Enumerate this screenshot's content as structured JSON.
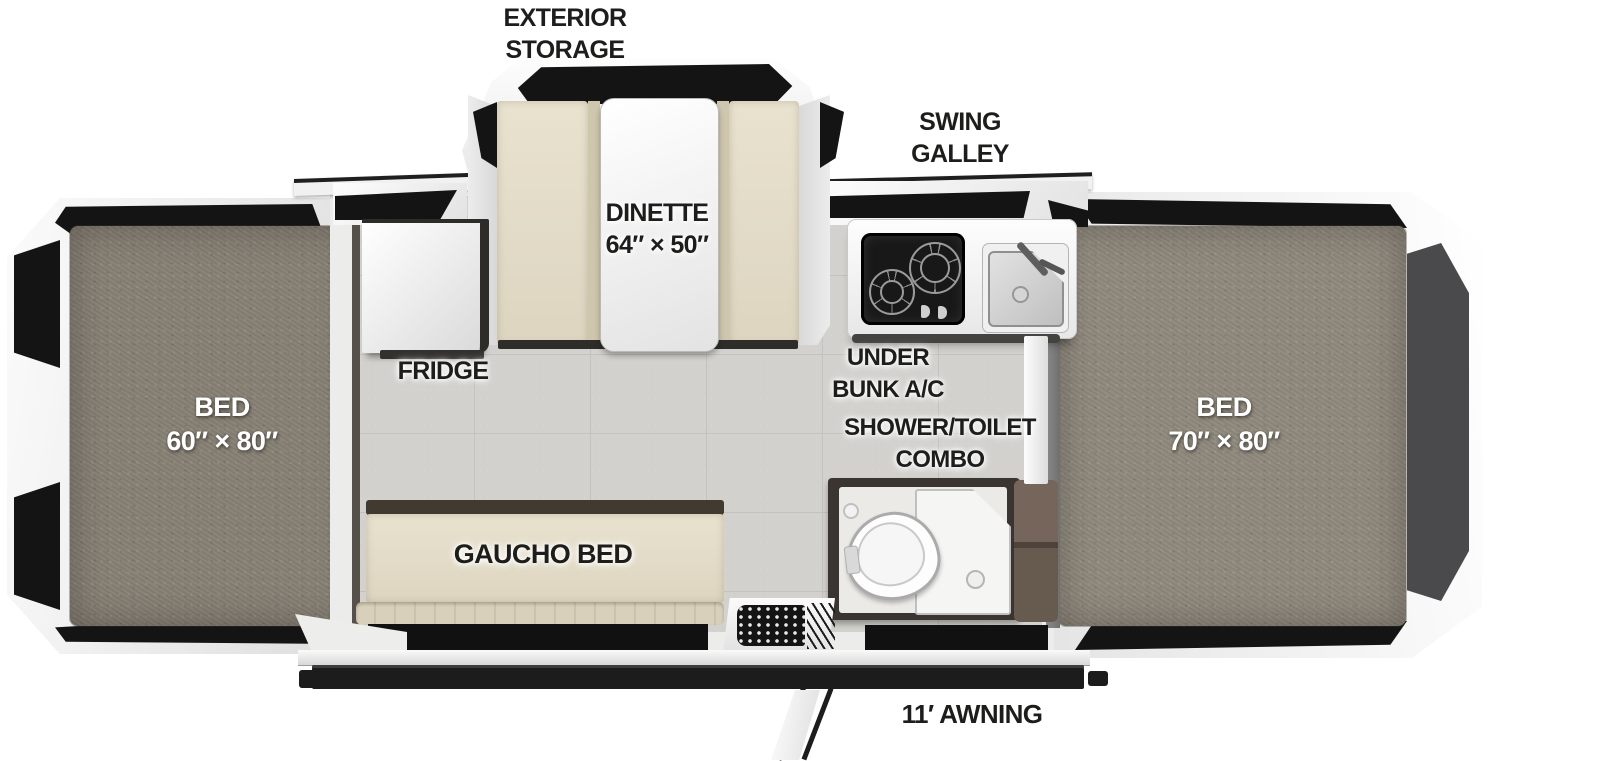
{
  "floorplan": {
    "areas": {
      "exterior_storage": {
        "lines": [
          "EXTERIOR",
          "STORAGE"
        ]
      },
      "swing_galley": {
        "lines": [
          "SWING",
          "GALLEY"
        ]
      },
      "dinette": {
        "name": "DINETTE",
        "size": "64″ × 50″"
      },
      "fridge": {
        "name": "FRIDGE"
      },
      "under_bunk_ac": {
        "lines": [
          "UNDER",
          "BUNK A/C"
        ]
      },
      "shower_toilet_combo": {
        "lines": [
          "SHOWER/TOILET",
          "COMBO"
        ]
      },
      "gaucho_bed": {
        "name": "GAUCHO BED"
      },
      "bed_left": {
        "name": "BED",
        "size": "60″ × 80″"
      },
      "bed_right": {
        "name": "BED",
        "size": "70″ × 80″"
      },
      "awning": {
        "name": "11′ AWNING"
      }
    },
    "colors": {
      "body_white": "#f2f2f1",
      "trim_black": "#141414",
      "mattress_gray": "#8b857a",
      "cushion_beige": "#e4ddc9",
      "floor_tile": "#d2d1cd",
      "cabinet_brown": "#6a5c50",
      "label_text": "#1d1d1b",
      "bed_label_text": "#ffffff"
    }
  }
}
